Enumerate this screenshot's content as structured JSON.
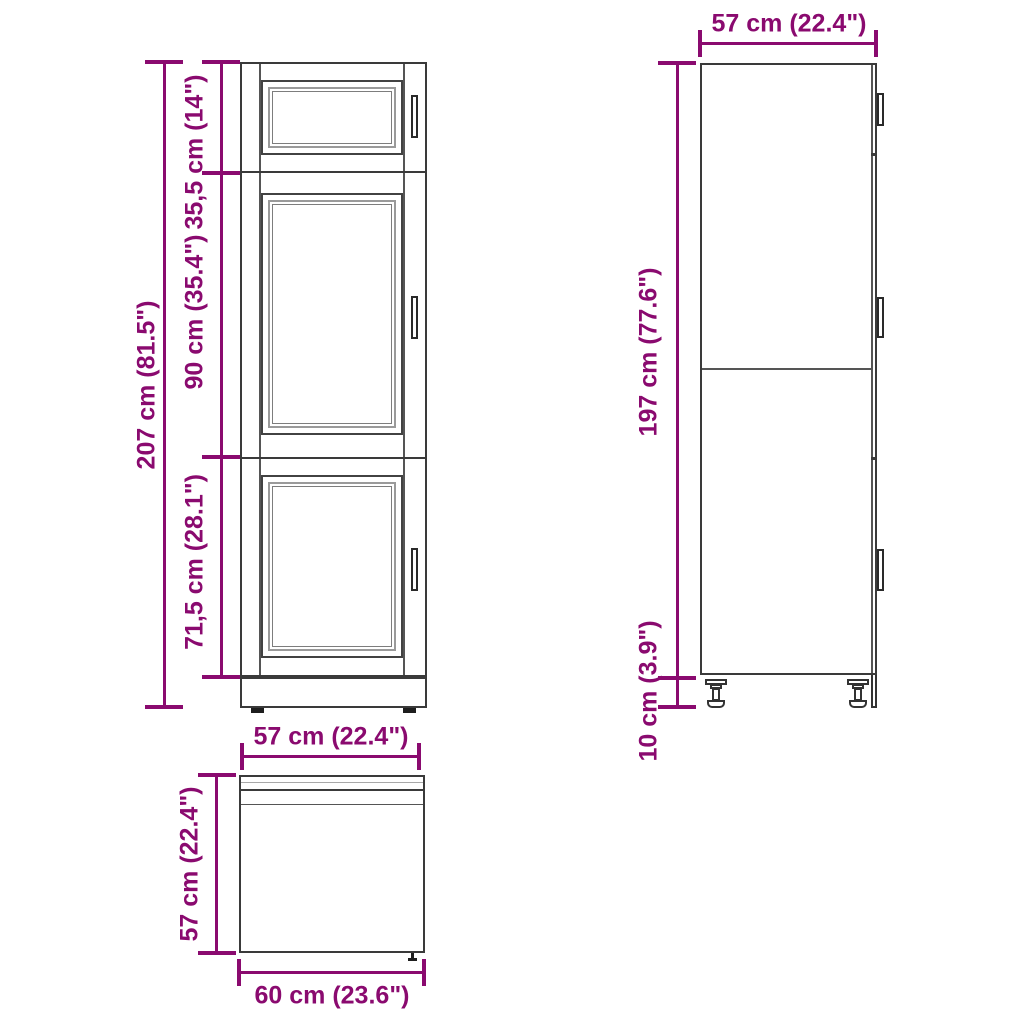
{
  "accent_color": "#8a0a6f",
  "drawing_line_color": "#3a3a3a",
  "diagram": {
    "type": "furniture-dimension-drawing",
    "subject": "tall kitchen cabinet, three orthographic views",
    "front_view": {
      "dim_total_height": "207 cm (81.5\")",
      "dim_top_section": "35,5 cm (14\")",
      "dim_middle_section": "90 cm (35.4\")",
      "dim_bottom_section": "71,5 cm (28.1\")"
    },
    "side_view": {
      "dim_depth": "57 cm (22.4\")",
      "dim_body_height": "197 cm (77.6\")",
      "dim_leg_height": "10 cm (3.9\")"
    },
    "top_view": {
      "dim_inner_width": "57 cm (22.4\")",
      "dim_depth": "57 cm (22.4\")",
      "dim_outer_width": "60 cm (23.6\")"
    }
  }
}
